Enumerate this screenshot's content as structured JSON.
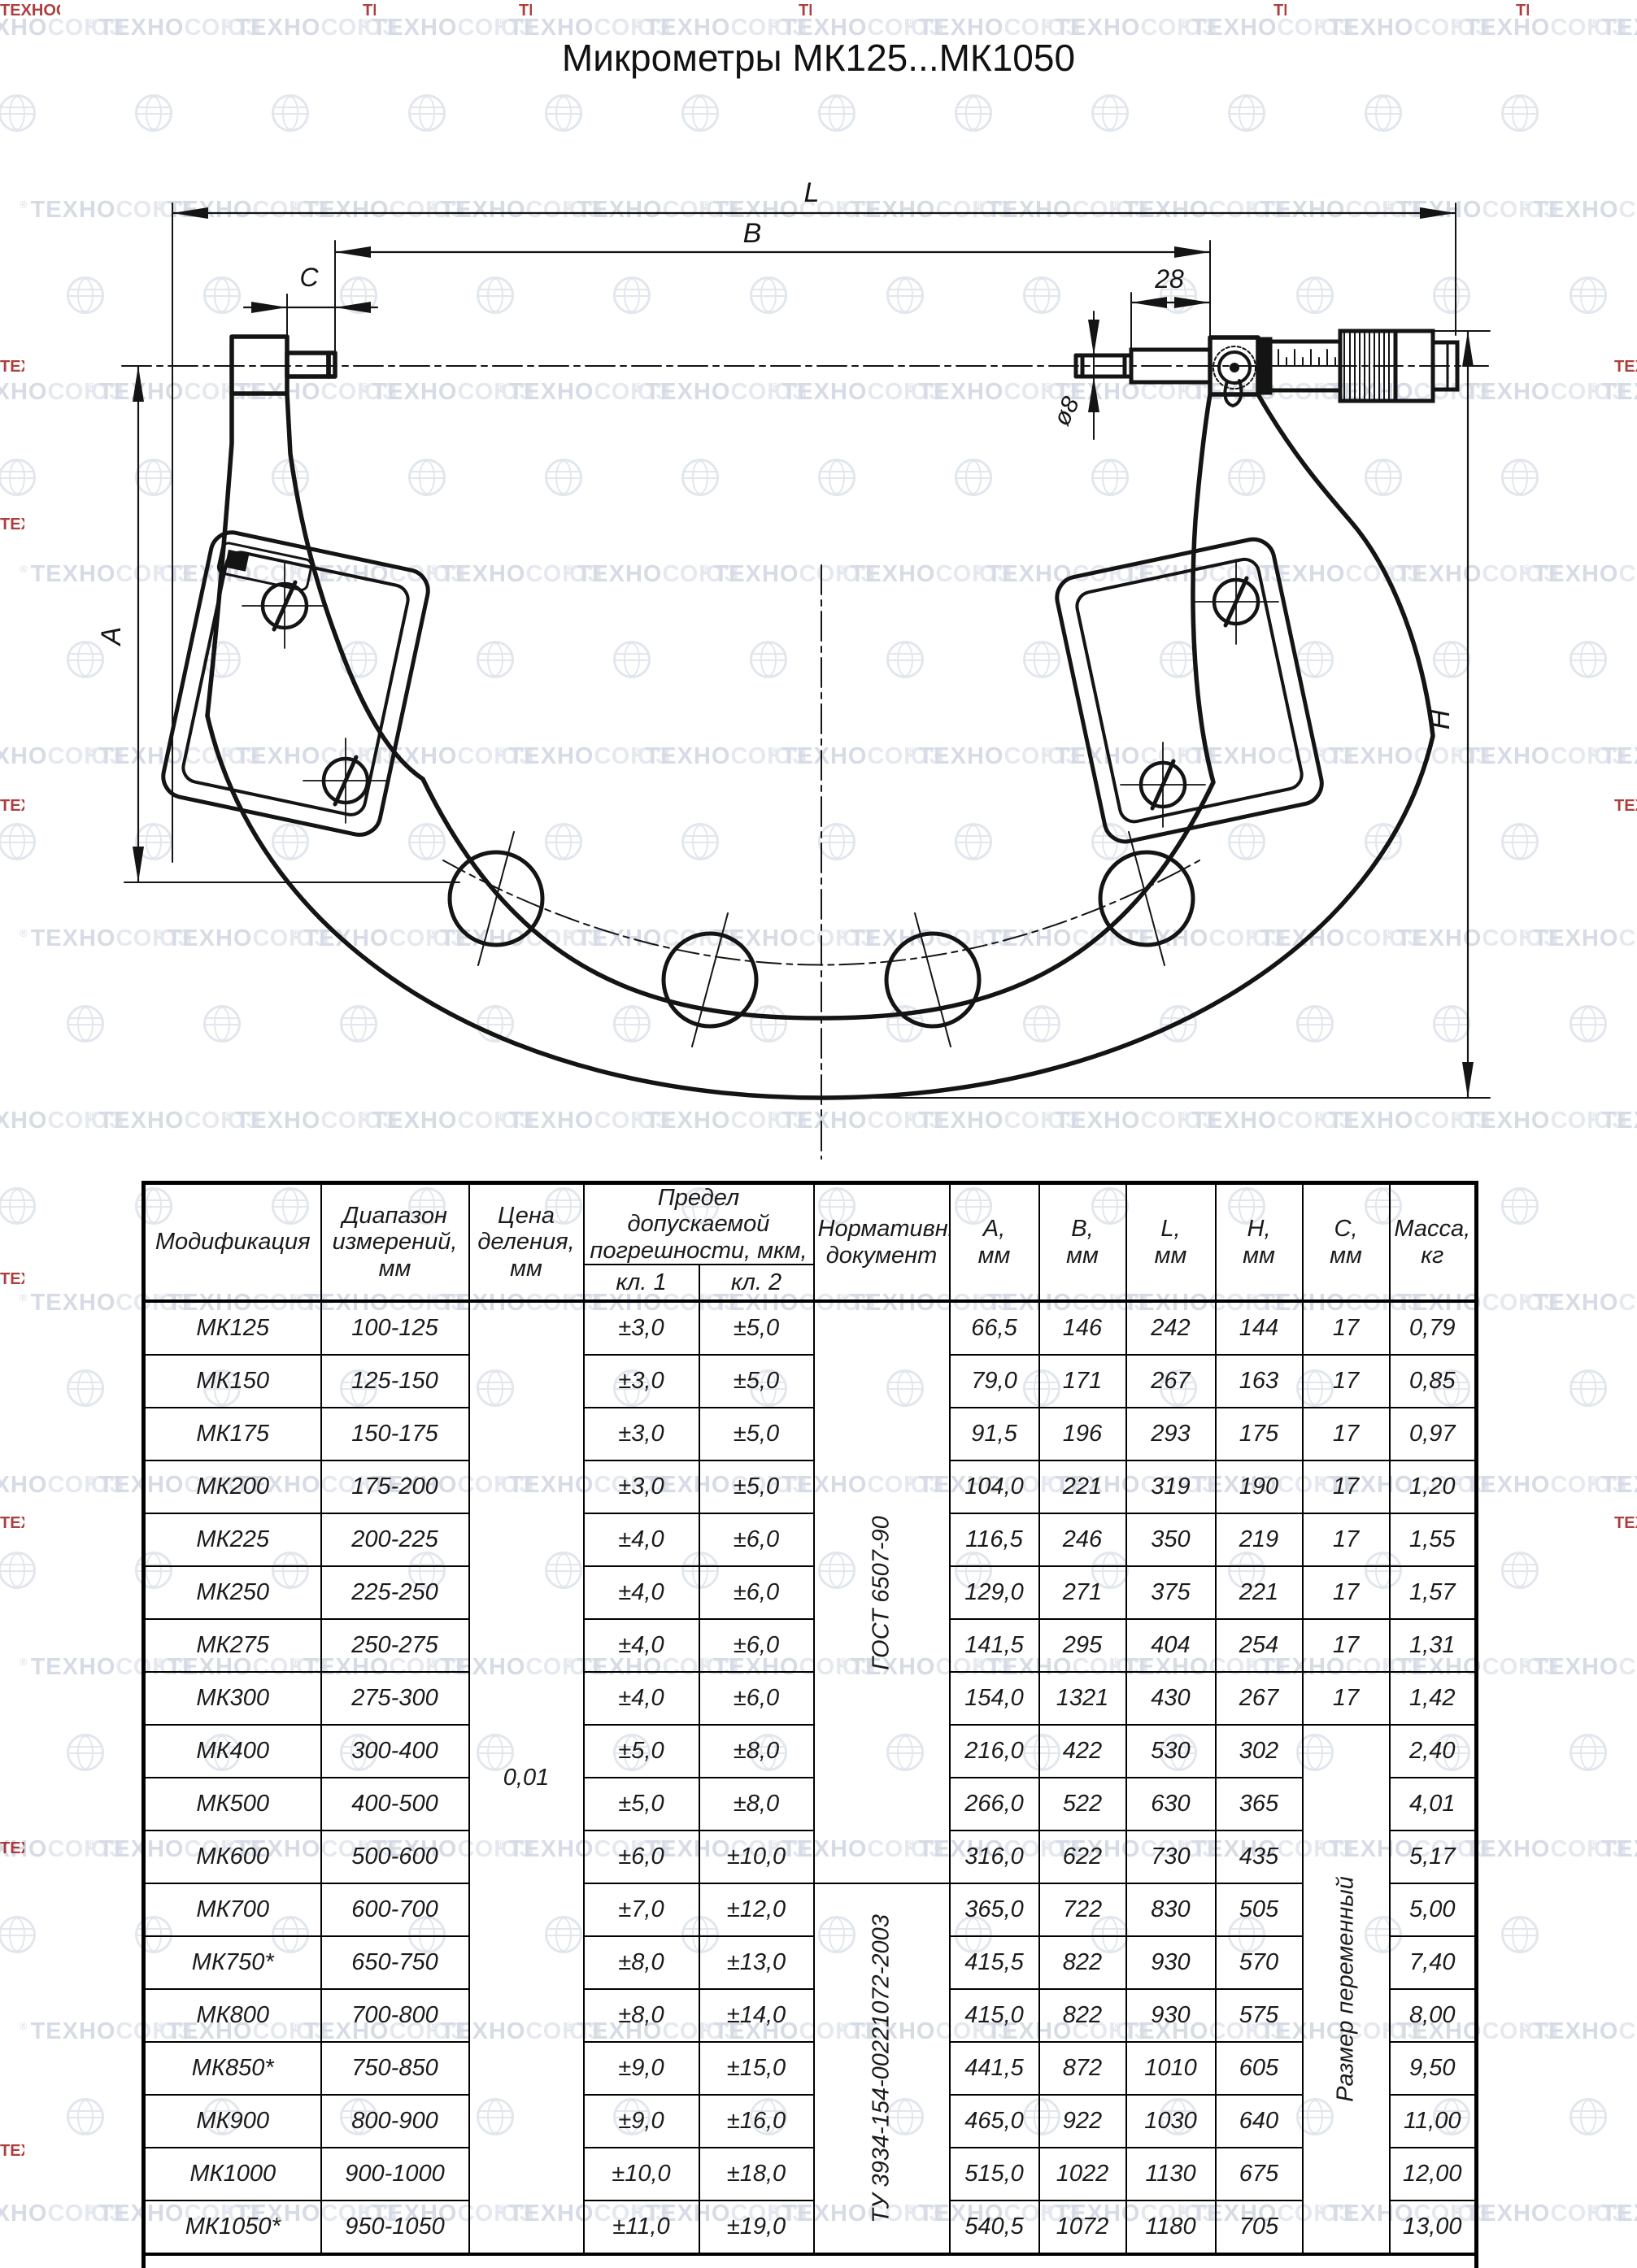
{
  "watermark": {
    "brand": "ТЕХНОСОЮЗ",
    "reg": "®"
  },
  "colors": {
    "line": "#141414",
    "red_mark": "#a11d1d",
    "watermark": "#b9c2d4"
  },
  "title": "Микрометры МК125...МК1050",
  "drawing": {
    "labels": {
      "L": "L",
      "B": "В",
      "C": "С",
      "d28": "28",
      "dia8": "ø8",
      "A": "А",
      "H": "Н"
    }
  },
  "table": {
    "headers": {
      "model": "Модификация",
      "range": "Диапазон\nизмерений,\nмм",
      "division": "Цена\nделения,\nмм",
      "error": "Предел допускаемой\nпогрешности, мкм,",
      "cl1": "кл. 1",
      "cl2": "кл. 2",
      "doc": "Нормативный\nдокумент",
      "a": "А,\nмм",
      "b": "В,\nмм",
      "l": "L,\nмм",
      "h": "Н,\nмм",
      "c": "С,\nмм",
      "mass": "Масса,\nкг"
    },
    "merged": {
      "division": "0,01",
      "doc1": "ГОСТ 6507-90",
      "doc1_rows": 11,
      "doc2": "ТУ 3934-154-00221072-2003",
      "doc2_rows": 7,
      "c_variable": "Размер переменный",
      "c_variable_rows": 10
    },
    "rows": [
      {
        "model": "МК125",
        "range": "100-125",
        "cl1": "±3,0",
        "cl2": "±5,0",
        "a": "66,5",
        "b": "146",
        "l": "242",
        "h": "144",
        "c": "17",
        "mass": "0,79"
      },
      {
        "model": "МК150",
        "range": "125-150",
        "cl1": "±3,0",
        "cl2": "±5,0",
        "a": "79,0",
        "b": "171",
        "l": "267",
        "h": "163",
        "c": "17",
        "mass": "0,85"
      },
      {
        "model": "МК175",
        "range": "150-175",
        "cl1": "±3,0",
        "cl2": "±5,0",
        "a": "91,5",
        "b": "196",
        "l": "293",
        "h": "175",
        "c": "17",
        "mass": "0,97"
      },
      {
        "model": "МК200",
        "range": "175-200",
        "cl1": "±3,0",
        "cl2": "±5,0",
        "a": "104,0",
        "b": "221",
        "l": "319",
        "h": "190",
        "c": "17",
        "mass": "1,20"
      },
      {
        "model": "МК225",
        "range": "200-225",
        "cl1": "±4,0",
        "cl2": "±6,0",
        "a": "116,5",
        "b": "246",
        "l": "350",
        "h": "219",
        "c": "17",
        "mass": "1,55"
      },
      {
        "model": "МК250",
        "range": "225-250",
        "cl1": "±4,0",
        "cl2": "±6,0",
        "a": "129,0",
        "b": "271",
        "l": "375",
        "h": "221",
        "c": "17",
        "mass": "1,57"
      },
      {
        "model": "МК275",
        "range": "250-275",
        "cl1": "±4,0",
        "cl2": "±6,0",
        "a": "141,5",
        "b": "295",
        "l": "404",
        "h": "254",
        "c": "17",
        "mass": "1,31"
      },
      {
        "model": "МК300",
        "range": "275-300",
        "cl1": "±4,0",
        "cl2": "±6,0",
        "a": "154,0",
        "b": "1321",
        "l": "430",
        "h": "267",
        "c": "17",
        "mass": "1,42"
      },
      {
        "model": "МК400",
        "range": "300-400",
        "cl1": "±5,0",
        "cl2": "±8,0",
        "a": "216,0",
        "b": "422",
        "l": "530",
        "h": "302",
        "mass": "2,40"
      },
      {
        "model": "МК500",
        "range": "400-500",
        "cl1": "±5,0",
        "cl2": "±8,0",
        "a": "266,0",
        "b": "522",
        "l": "630",
        "h": "365",
        "mass": "4,01"
      },
      {
        "model": "МК600",
        "range": "500-600",
        "cl1": "±6,0",
        "cl2": "±10,0",
        "a": "316,0",
        "b": "622",
        "l": "730",
        "h": "435",
        "mass": "5,17"
      },
      {
        "model": "МК700",
        "range": "600-700",
        "cl1": "±7,0",
        "cl2": "±12,0",
        "a": "365,0",
        "b": "722",
        "l": "830",
        "h": "505",
        "mass": "5,00"
      },
      {
        "model": "МК750*",
        "range": "650-750",
        "cl1": "±8,0",
        "cl2": "±13,0",
        "a": "415,5",
        "b": "822",
        "l": "930",
        "h": "570",
        "mass": "7,40"
      },
      {
        "model": "МК800",
        "range": "700-800",
        "cl1": "±8,0",
        "cl2": "±14,0",
        "a": "415,0",
        "b": "822",
        "l": "930",
        "h": "575",
        "mass": "8,00"
      },
      {
        "model": "МК850*",
        "range": "750-850",
        "cl1": "±9,0",
        "cl2": "±15,0",
        "a": "441,5",
        "b": "872",
        "l": "1010",
        "h": "605",
        "mass": "9,50"
      },
      {
        "model": "МК900",
        "range": "800-900",
        "cl1": "±9,0",
        "cl2": "±16,0",
        "a": "465,0",
        "b": "922",
        "l": "1030",
        "h": "640",
        "mass": "11,00"
      },
      {
        "model": "МК1000",
        "range": "900-1000",
        "cl1": "±10,0",
        "cl2": "±18,0",
        "a": "515,0",
        "b": "1022",
        "l": "1130",
        "h": "675",
        "mass": "12,00"
      },
      {
        "model": "МК1050*",
        "range": "950-1050",
        "cl1": "±11,0",
        "cl2": "±19,0",
        "a": "540,5",
        "b": "1072",
        "l": "1180",
        "h": "705",
        "mass": "13,00"
      }
    ],
    "footnote": "* Микрометры выпускаются по заказу потребителя"
  }
}
